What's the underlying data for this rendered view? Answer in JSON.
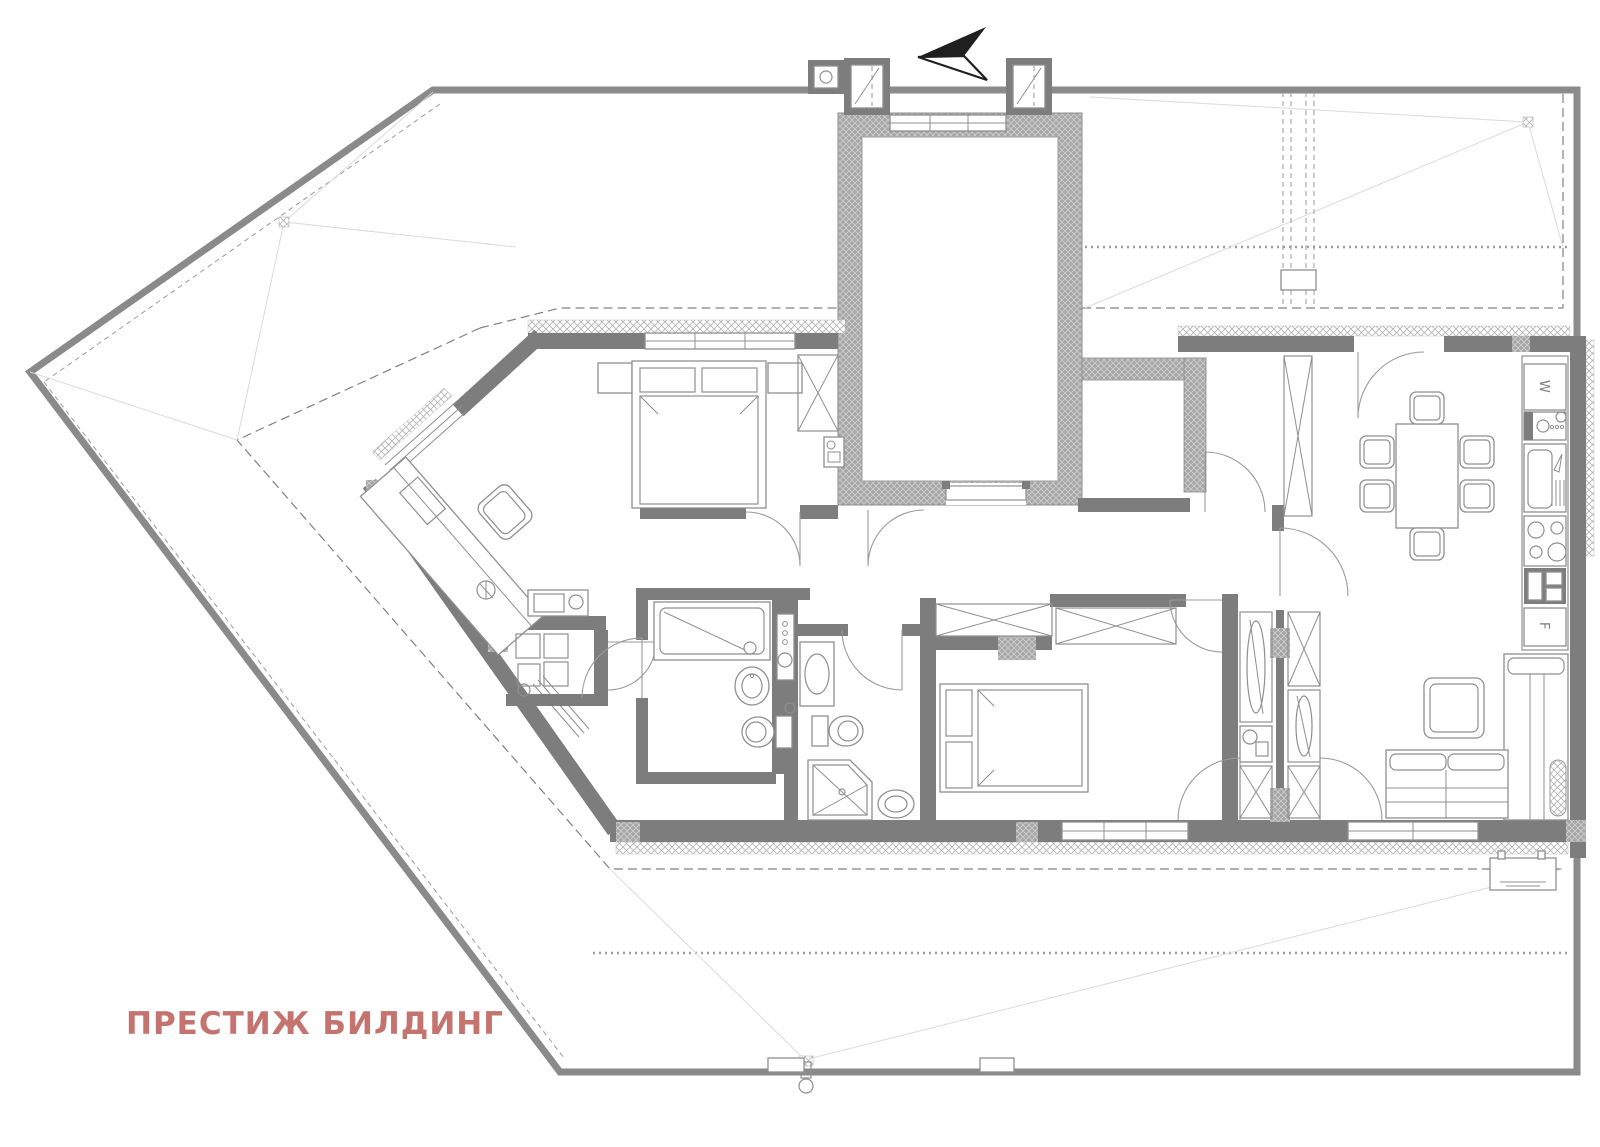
{
  "brand": {
    "label": "ПРЕСТИЖ БИЛДИНГ",
    "color": "#c4736f"
  },
  "appliances": {
    "washer_label": "W",
    "fridge_label": "F"
  },
  "icons": {
    "north_arrow": "north-direction-arrow"
  },
  "colors": {
    "wall": "#7d7d7d",
    "outline": "#8a8a8a",
    "line": "#8f8f8f",
    "faint": "#dadada",
    "background": "#ffffff"
  }
}
